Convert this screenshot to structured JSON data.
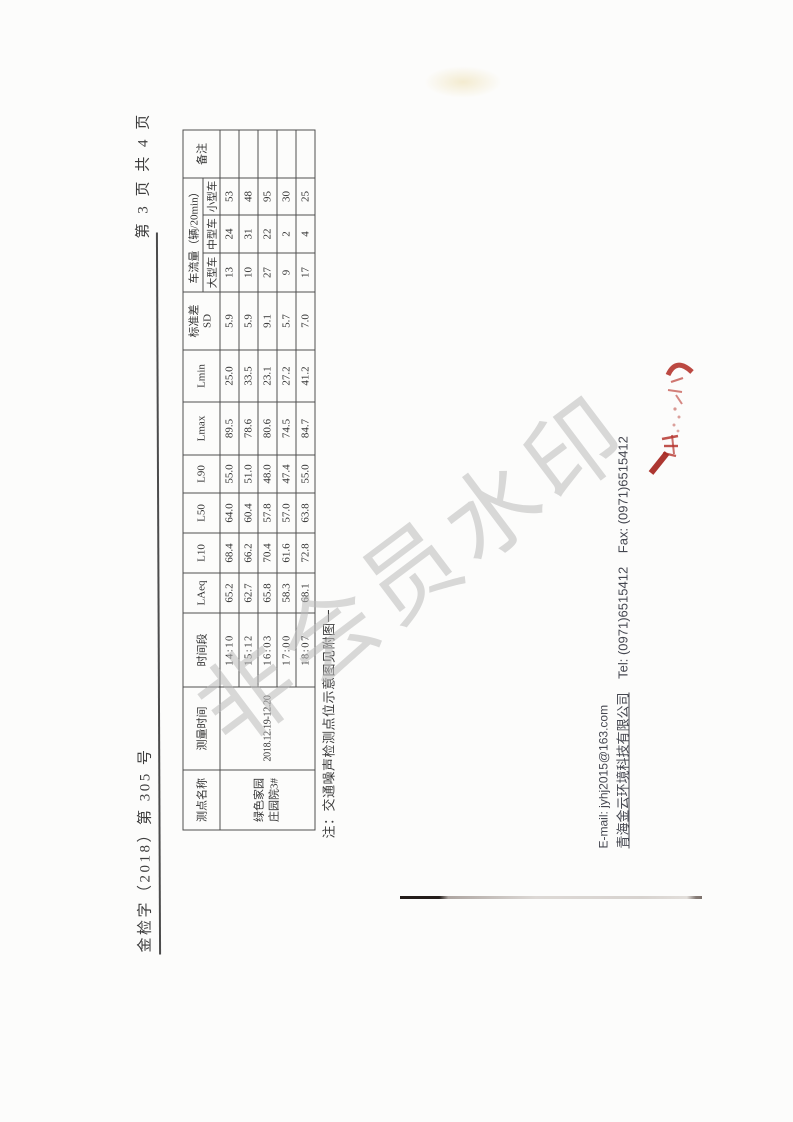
{
  "page": {
    "doc_number": "金检字（2018）第 305 号",
    "page_indicator": "第 3 页 共 4 页"
  },
  "table": {
    "headers": {
      "point_name": "测点名称",
      "measure_date": "测量时间",
      "time_slot": "时间段",
      "laeq": "LAeq",
      "l10": "L10",
      "l50": "L50",
      "l90": "L90",
      "lmax": "Lmax",
      "lmin": "Lmin",
      "sd_line1": "标准差",
      "sd_line2": "SD",
      "traffic_group": "车流量（辆/20min）",
      "large_vehicle": "大型车",
      "medium_vehicle": "中型车",
      "small_vehicle": "小型车",
      "remark": "备注"
    },
    "point_name_line1": "绿色家园",
    "point_name_line2": "庄园院3#",
    "measure_date": "2018.12.19-12.20",
    "rows": [
      {
        "time": "14:10",
        "laeq": "65.2",
        "l10": "68.4",
        "l50": "64.0",
        "l90": "55.0",
        "lmax": "89.5",
        "lmin": "25.0",
        "sd": "5.9",
        "large": "13",
        "medium": "24",
        "small": "53",
        "remark": ""
      },
      {
        "time": "15:12",
        "laeq": "62.7",
        "l10": "66.2",
        "l50": "60.4",
        "l90": "51.0",
        "lmax": "78.6",
        "lmin": "33.5",
        "sd": "5.9",
        "large": "10",
        "medium": "31",
        "small": "48",
        "remark": ""
      },
      {
        "time": "16:03",
        "laeq": "65.8",
        "l10": "70.4",
        "l50": "57.8",
        "l90": "48.0",
        "lmax": "80.6",
        "lmin": "23.1",
        "sd": "9.1",
        "large": "27",
        "medium": "22",
        "small": "95",
        "remark": ""
      },
      {
        "time": "17:00",
        "laeq": "58.3",
        "l10": "61.6",
        "l50": "57.0",
        "l90": "47.4",
        "lmax": "74.5",
        "lmin": "27.2",
        "sd": "5.7",
        "large": "9",
        "medium": "2",
        "small": "30",
        "remark": ""
      },
      {
        "time": "18:07",
        "laeq": "68.1",
        "l10": "72.8",
        "l50": "63.8",
        "l90": "55.0",
        "lmax": "84.7",
        "lmin": "41.2",
        "sd": "7.0",
        "large": "17",
        "medium": "4",
        "small": "25",
        "remark": ""
      }
    ]
  },
  "note": "注：交通噪声检测点位示意图见附图一",
  "footer": {
    "email_line": "E-mail: jyhj2015@163.com",
    "company_name": "青海金云环境科技有限公司",
    "tel": "Tel: (0971)6515412",
    "fax": "Fax: (0971)6515412"
  },
  "watermark_text": "非会员水印",
  "colors": {
    "stamp_red": "#b5352e",
    "watermark_gray": "#bababa",
    "ink": "#3a3a3a"
  }
}
